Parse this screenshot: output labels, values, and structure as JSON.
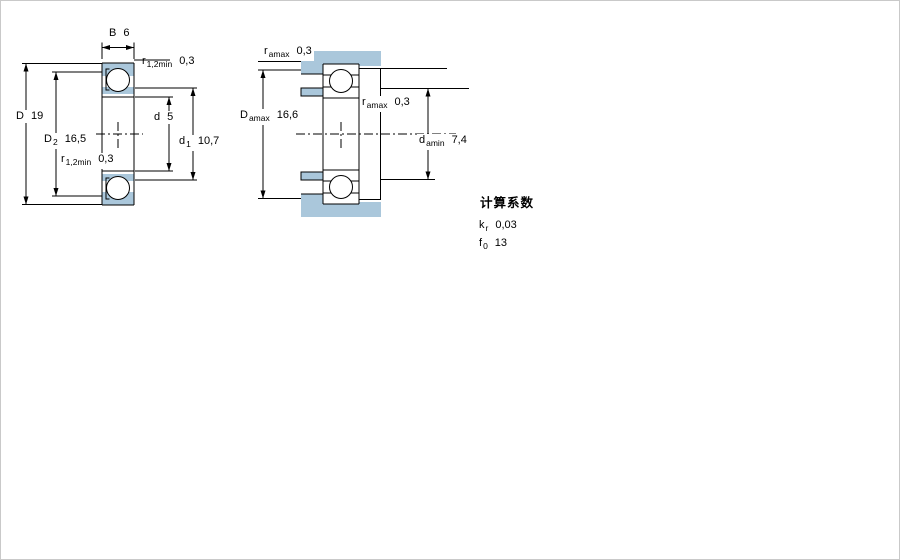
{
  "colors": {
    "fill_blue": "#aac7db",
    "line": "#000000",
    "background": "#ffffff",
    "border": "#c9c9c9"
  },
  "diagram_left": {
    "description": "bearing cross-section with shield, boundary dimensions",
    "labels": {
      "width": {
        "main": "B",
        "value": "6"
      },
      "r_chamfer_top": {
        "main": "r",
        "sub": "1,2min",
        "value": "0,3"
      },
      "outer_diameter": {
        "main": "D",
        "value": "19"
      },
      "recess_diameter": {
        "main": "D",
        "sub": "2",
        "value": "16,5"
      },
      "r_chamfer_bottom": {
        "main": "r",
        "sub": "1,2min",
        "value": "0,3"
      },
      "bore_diameter": {
        "main": "d",
        "value": "5"
      },
      "shoulder_diameter": {
        "main": "d",
        "sub": "1",
        "value": "10,7"
      }
    }
  },
  "diagram_right": {
    "description": "bearing mounting dimensions with shaft and housing abutments",
    "labels": {
      "r_fillet_top": {
        "main": "r",
        "sub": "amax",
        "value": "0,3"
      },
      "housing_abutment_diameter": {
        "main": "D",
        "sub": "amax",
        "value": "16,6"
      },
      "r_fillet_mid": {
        "main": "r",
        "sub": "amax",
        "value": "0,3"
      },
      "shaft_abutment_diameter": {
        "main": "d",
        "sub": "amin",
        "value": "7,4"
      }
    }
  },
  "calculation_factors": {
    "heading": "计算系数",
    "kr": {
      "main": "k",
      "sub": "r",
      "value": "0,03"
    },
    "f0": {
      "main": "f",
      "sub": "0",
      "value": "13"
    }
  }
}
